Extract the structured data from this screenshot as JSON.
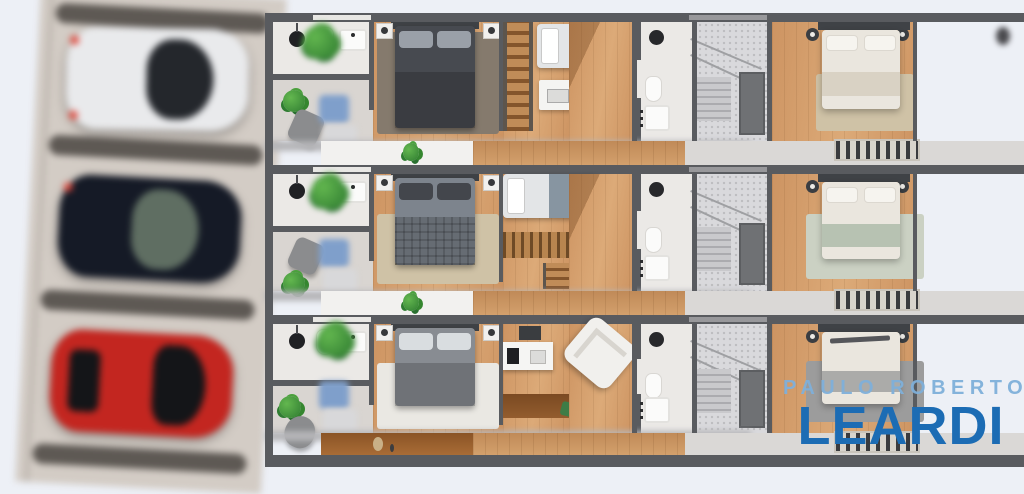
{
  "scene": {
    "type": "real-estate floor plan render",
    "floor_plan_strips": 3,
    "parking": {
      "stalls": 3,
      "cars": [
        {
          "position": "top",
          "color_name": "white",
          "hex": "#e9eaec"
        },
        {
          "position": "middle",
          "color_name": "dark-navy",
          "hex": "#151a26"
        },
        {
          "position": "bottom",
          "color_name": "red",
          "hex": "#c32620"
        }
      ]
    }
  },
  "watermark": {
    "line1": "PAULO ROBERTO",
    "line2": "LEARDI",
    "line1_color": "#7fb0da",
    "line2_color": "#1c6cb4"
  },
  "palette": {
    "bg": "#edf0f6",
    "wall": "#595b5f",
    "wall_dark": "#3f4246",
    "wood": "#cd9462",
    "wood_light": "#dcaa78",
    "wood_dark": "#9c6336",
    "tile": "#ebe9e6",
    "tile_gray": "#d9d5d1",
    "stair": "#d9d9dc",
    "balcony": "#f2f1ef",
    "glass_teal": "#3fae97",
    "plant": "#3f9741",
    "chair_gray": "#8b8c8e",
    "bed_dark": "#474a50",
    "pillow_gray": "#9aa0a8",
    "bed_mid": "#7d848d",
    "bed_light": "#888c92",
    "bedding_cream": "#eae6de",
    "throw_sage": "#b7c2b2",
    "rug_brown": "#857a6d",
    "rug_beige": "#cfc2a6",
    "rug_white": "#eae8e3",
    "rug_sage": "#cbd1c3",
    "rug_gray": "#9c9c9c",
    "park_bg": "#d3ccc5",
    "divider": "#5e5954",
    "car_white": "#e9eaec",
    "car_navy": "#151a26",
    "car_red": "#c32620",
    "glass_dark": "#24272c",
    "brand_blue": "#1c6cb4",
    "brand_light": "#7fb0da",
    "outdoor": "#e8e8e9",
    "blob_blue": "#7f9fcb"
  }
}
